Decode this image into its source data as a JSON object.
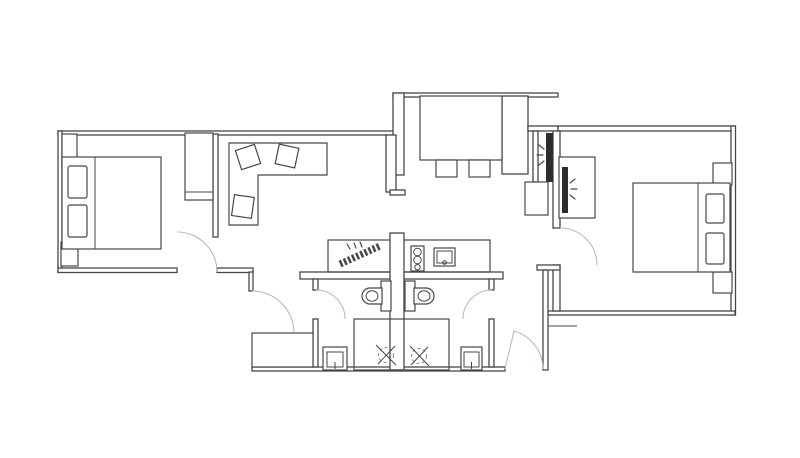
{
  "meta": {
    "title": "Apartment floor plan",
    "description": "Top-down black-and-white architectural floor plan of a mirrored two-bedroom unit"
  },
  "colors": {
    "background": "#ffffff",
    "line": "#474747",
    "door_arc": "#b4bcbc",
    "dashed": "#8a8a8a",
    "panel_dark": "#2d2d2d"
  },
  "canvas": {
    "width": 800,
    "height": 458
  },
  "rooms": [
    {
      "name": "Left bedroom",
      "furniture": [
        "double bed",
        "two pillows",
        "top nightstand",
        "bottom nightstand",
        "wardrobe",
        "door swing"
      ]
    },
    {
      "name": "Living area",
      "furniture": [
        "L-shaped sofa",
        "three loose cushions"
      ]
    },
    {
      "name": "Entry hall",
      "furniture": [
        "built-in closet",
        "side panels",
        "two shoe cabinets"
      ]
    },
    {
      "name": "Right vestibule",
      "furniture": [
        "mirrored panel with shine rays",
        "low cabinet"
      ]
    },
    {
      "name": "Right bedroom",
      "furniture": [
        "double bed",
        "two pillows",
        "two nightstands",
        "mirror cabinet with shine rays",
        "door swing"
      ]
    },
    {
      "name": "Kitchen",
      "furniture": [
        "counter",
        "diagonal dish rack",
        "cooktop with burners",
        "sink with faucet"
      ]
    },
    {
      "name": "Left bathroom",
      "furniture": [
        "toilet",
        "shower with drain symbol",
        "wash basin",
        "vanity counter",
        "door swing"
      ]
    },
    {
      "name": "Right bathroom",
      "furniture": [
        "toilet",
        "shower with drain symbol",
        "wash basin",
        "door swing"
      ]
    }
  ]
}
